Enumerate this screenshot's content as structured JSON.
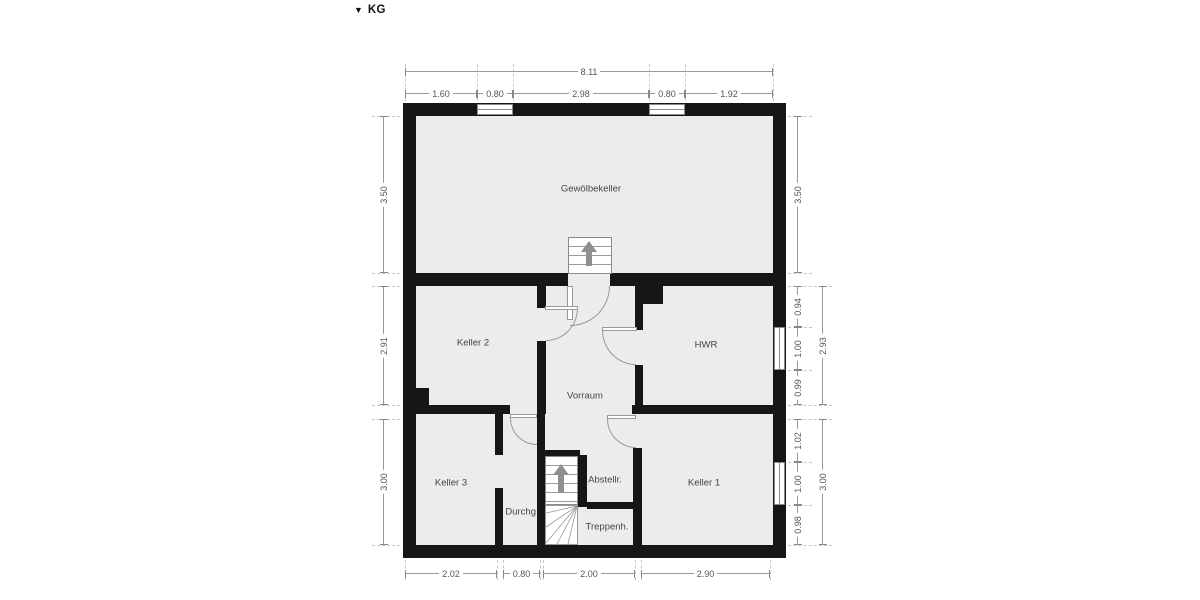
{
  "title": {
    "icon": "▼",
    "label": "KG"
  },
  "rooms": {
    "gewoelbekeller": "Gewölbekeller",
    "keller2": "Keller 2",
    "hwr": "HWR",
    "vorraum": "Vorraum",
    "keller3": "Keller 3",
    "durchgang": "Durchg.",
    "treppenhaus": "Treppenh.",
    "abstellraum": "Abstellr.",
    "keller1": "Keller 1"
  },
  "dims": {
    "top_total": "8.11",
    "top_segments": [
      "1.60",
      "0.80",
      "2.98",
      "0.80",
      "1.92"
    ],
    "left_segments": [
      "3.50",
      "2.91",
      "3.00"
    ],
    "right_top": "3.50",
    "right_mid_segments": [
      "0.94",
      "1.00",
      "0.99"
    ],
    "right_mid_total": "2.93",
    "right_bot_segments": [
      "1.02",
      "1.00",
      "0.98"
    ],
    "right_bot_total": "3.00",
    "bottom_segments": [
      "2.02",
      "0.80",
      "2.00",
      "2.90"
    ]
  },
  "colors": {
    "wall": "#161616",
    "floor": "#ececec",
    "dim_line": "#8a8a8a",
    "dim_text": "#555555",
    "room_text": "#444444"
  }
}
